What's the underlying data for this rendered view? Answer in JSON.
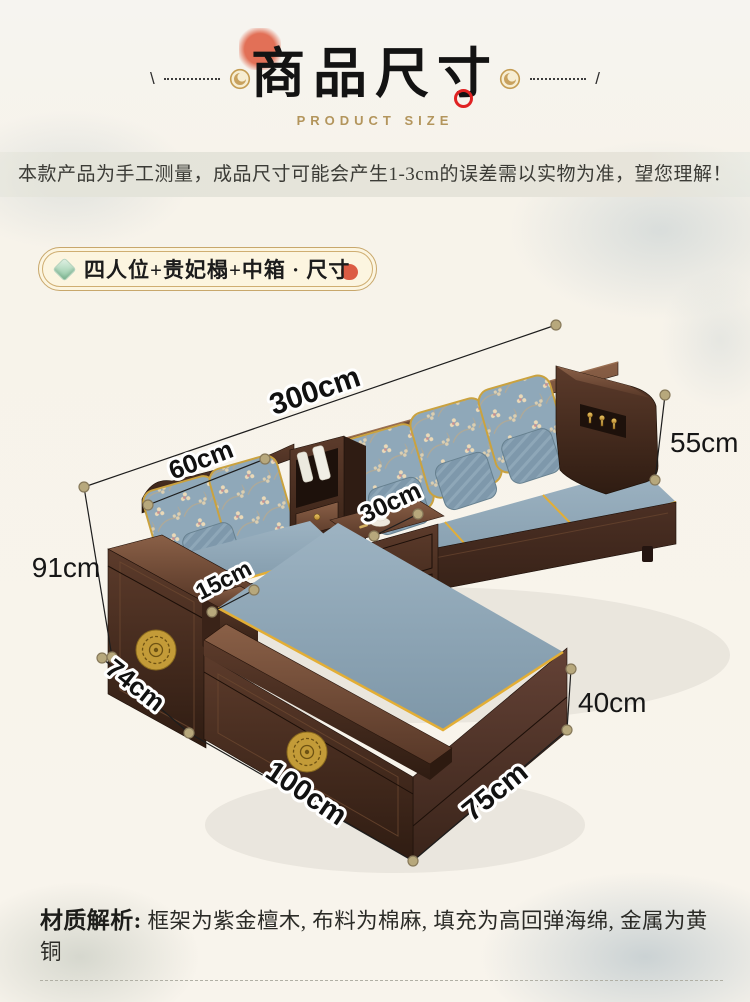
{
  "header": {
    "title": "商品尺寸",
    "subtitle": "PRODUCT SIZE",
    "left_slash": "\\",
    "right_slash": "/"
  },
  "disclaimer": "本款产品为手工测量，成品尺寸可能会产生1-3cm的误差需以实物为准，望您理解！",
  "badge": {
    "label": "四人位+贵妃榻+中箱 · 尺寸"
  },
  "diagram": {
    "description": "L-shaped Chinese dark-wood sofa with blue cushions, dimension annotations",
    "dimensions": [
      {
        "name": "total-length",
        "label": "300cm"
      },
      {
        "name": "back-height",
        "label": "55cm"
      },
      {
        "name": "backrest-width",
        "label": "60cm"
      },
      {
        "name": "middle-box-top",
        "label": "30cm"
      },
      {
        "name": "overall-height",
        "label": "91cm"
      },
      {
        "name": "armrest-width",
        "label": "15cm"
      },
      {
        "name": "side-depth",
        "label": "74cm"
      },
      {
        "name": "chaise-height",
        "label": "40cm"
      },
      {
        "name": "chaise-length",
        "label": "100cm"
      },
      {
        "name": "chaise-width",
        "label": "75cm"
      }
    ]
  },
  "materials": {
    "heading": "材质解析:",
    "text": "框架为紫金檀木, 布料为棉麻, 填充为高回弹海绵, 金属为黄铜"
  },
  "colors": {
    "accent_red": "#e02222",
    "gold": "#c8a76b",
    "wood_dark": "#3a251b",
    "cushion_blue": "#8ea6b6",
    "background": "#f8f4ec"
  }
}
